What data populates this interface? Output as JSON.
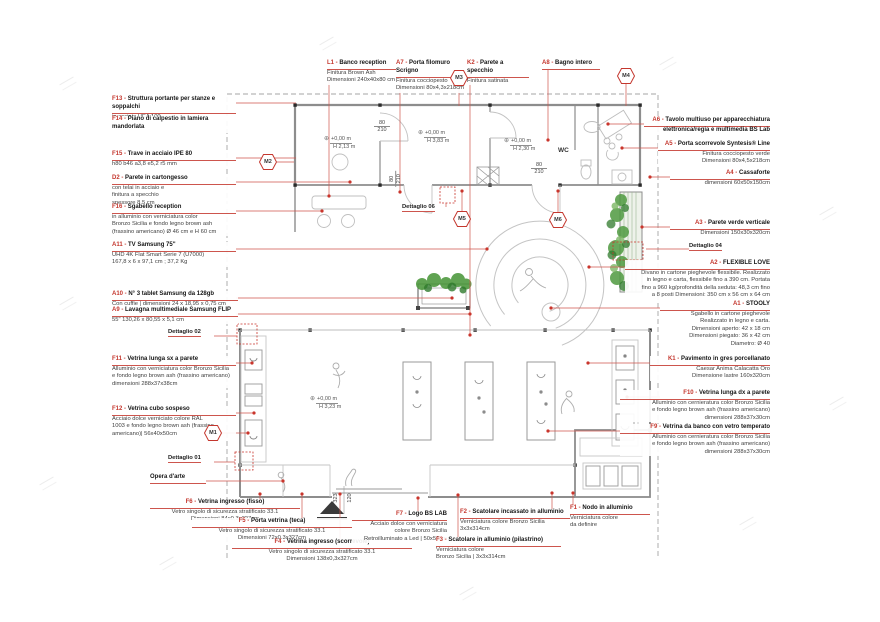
{
  "colors": {
    "annotation_red": "#c4372e",
    "plan_gray": "#8d8d8d",
    "plant_green": "#4f9a40"
  },
  "annotations": {
    "left": [
      {
        "code": "F13 -",
        "title": "Struttura portante per stanze e soppalchi",
        "lines": [
          "in acciaio HEA 100"
        ]
      },
      {
        "code": "F14 -",
        "title": "Piano di calpestio in lamiera mandorlata",
        "lines": []
      },
      {
        "code": "F15 -",
        "title": "Trave in acciaio IPE 80",
        "lines": [
          "h80 b46 a3,8 e5,2 r5 mm"
        ]
      },
      {
        "code": "D2 -",
        "title": "Parete in cartongesso",
        "lines": [
          "con telai in acciaio e",
          "finitura a specchio",
          "spessore 8,5 cm"
        ]
      },
      {
        "code": "F16 -",
        "title": "Sgabello reception",
        "lines": [
          "in alluminio con verniciatura color",
          "Bronzo Sicilia e fondo legno brown ash",
          "(frassino americano) Ø 46 cm e H 60 cm"
        ]
      },
      {
        "code": "A11 -",
        "title": "TV Samsung 75\"",
        "lines": [
          "UHD 4K Flat Smart Serie 7 (U7000)",
          "167,8 x 6 x 97,1 cm ; 37,2 Kg"
        ]
      },
      {
        "code": "A10 -",
        "title": "N° 3 tablet Samsung da 128gb",
        "lines": [
          "Con cuffie | dimensioni 24 x 18,95 x 0,75 cm"
        ]
      },
      {
        "code": "A9 -",
        "title": "Lavagna multimediale Samsung FLIP",
        "lines": [
          "55\" 130,26 x 80,55 x 5,1 cm"
        ]
      },
      {
        "code": "F11 -",
        "title": "Vetrina lunga sx a parete",
        "lines": [
          "Alluminio con verniciatura color Bronzo Sicilia",
          "e fondo legno brown ash (frassino americano)",
          "dimensioni 288x37x38cm"
        ]
      },
      {
        "code": "F12 -",
        "title": "Vetrina cubo sospeso",
        "lines": [
          "Acciaio dolce verniciato colore RAL",
          "1003 e fondo legno brown ash (frassino",
          "americano)| 56x40x50cm"
        ]
      }
    ],
    "top": [
      {
        "code": "L1 -",
        "title": "Banco reception",
        "lines": [
          "Finitura Brown Ash",
          "Dimensioni 240x40x80 cm"
        ]
      },
      {
        "code": "A7 -",
        "title": "Porta filomuro Scrigno",
        "lines": [
          "Finitura cocciopesto",
          "Dimensioni 80x4,3x218cm"
        ]
      },
      {
        "code": "K2 -",
        "title": "Parete a specchio",
        "lines": [
          "Finitura satinata"
        ]
      },
      {
        "code": "A8 -",
        "title": "Bagno intero",
        "lines": []
      }
    ],
    "right": [
      {
        "code": "A6 -",
        "title": "Tavolo multiuso per apparecchiatura",
        "title2": "elettronica/regia e multimedia BS Lab",
        "lines": []
      },
      {
        "code": "A5 -",
        "title": "Porta scorrevole Syntesis® Line",
        "lines": [
          "Finitura cocciopesto verde",
          "Dimensioni 80x4,5x218cm"
        ]
      },
      {
        "code": "A4 -",
        "title": "Cassaforte",
        "lines": [
          "dimensioni 60x50x150cm"
        ]
      },
      {
        "code": "A3 -",
        "title": "Parete verde verticale",
        "lines": [
          "Dimensioni 150x30x320cm"
        ]
      },
      {
        "code": "A2 -",
        "title": "FLEXIBLE LOVE",
        "lines": [
          "Divano in cartone pieghevole flessibile. Realizzato",
          "in legno e carta, flessibile fino a 390 cm. Portata",
          "fino a 960 kg/profondità della seduta: 48,3 cm fino",
          "a 8 posti Dimensioni: 350 cm x 56 cm x 64 cm"
        ]
      },
      {
        "code": "A1 -",
        "title": "STOOLY",
        "lines": [
          "Sgabello in cartone pieghevole",
          "Realizzato in legno e carta.",
          "Dimensioni aperto: 42 x 18 cm",
          "Dimensioni piegato: 36 x 42 cm",
          "Diametro: Ø 40"
        ]
      },
      {
        "code": "K1 -",
        "title": "Pavimento in gres porcellanato",
        "lines": [
          "Caesar Anima Calacatta Oro",
          "Dimensione lastre 160x320cm"
        ]
      },
      {
        "code": "F10 -",
        "title": "Vetrina lunga dx a parete",
        "lines": [
          "Alluminio con cernieratura color Bronzo Sicilia",
          "e fondo legno brown ash (frassino americano)",
          "dimensioni 288x37x30cm"
        ]
      },
      {
        "code": "F9 -",
        "title": "Vetrina da banco con vetro temperato",
        "lines": [
          "Alluminio con cernieratura color Bronzo Sicilia",
          "e fondo legno brown ash (frassino americano)",
          "dimensioni 288x37x30cm"
        ]
      }
    ],
    "bottom": [
      {
        "code": "F6 -",
        "title": "Vetrina ingresso (fisso)",
        "lines": [
          "Vetro singolo di sicurezza stratificato 33.1",
          "Dimensioni 84x0,3x327cm"
        ]
      },
      {
        "code": "F5 -",
        "title": "Porta vetrina (teca)",
        "lines": [
          "Vetro singolo di sicurezza stratificato 33.1",
          "Dimensioni 72x0,3x327cm"
        ]
      },
      {
        "code": "F4 -",
        "title": "Vetrina ingresso (scorrevole)",
        "lines": [
          "Vetro singolo di sicurezza stratificato 33.1",
          "Dimensioni 138x0,3x327cm"
        ]
      },
      {
        "code": "F7 -",
        "title": "Logo BS LAB",
        "lines": [
          "Acciaio dolce con verniciatura",
          "colore Bronzo Sicilia",
          "Retroilluminato a Led | 50x50cm"
        ]
      },
      {
        "code": "F2 -",
        "title": "Scatolare incassato in alluminio",
        "lines": [
          "Verniciatura colore Bronzo Sicilia",
          "3x3x314cm"
        ]
      },
      {
        "code": "F1 -",
        "title": "Nodo in alluminio",
        "lines": [
          "Verniciatura colore",
          "da definire"
        ]
      },
      {
        "code": "F3 -",
        "title": "Scatolare in alluminio (pilastrino)",
        "lines": [
          "Verniciatura colore",
          "Bronzo Sicilia | 3x3x314cm"
        ]
      }
    ]
  },
  "markers": [
    "M1",
    "M2",
    "M3",
    "M4",
    "M5",
    "M6"
  ],
  "details": [
    "Dettaglio 01",
    "Dettaglio 02",
    "Dettaglio 04",
    "Dettaglio 06"
  ],
  "levels": [
    {
      "elev": "+0,00 m",
      "h": "H 2,13 m"
    },
    {
      "elev": "+0,00 m",
      "h": "H 3,83 m"
    },
    {
      "elev": "+0,00 m",
      "h": "H 2,30 m"
    },
    {
      "elev": "+0,00 m",
      "h": "H 3,23 m"
    }
  ],
  "door_dims": [
    {
      "w": "80",
      "h": "210"
    },
    {
      "w": "80",
      "h": "210"
    },
    {
      "w": "80",
      "h": "210"
    }
  ],
  "entry_dims": [
    "323",
    "120"
  ],
  "plan": {
    "wc": "WC",
    "opera": "Opera d'arte",
    "level_symbol": "⊕"
  }
}
